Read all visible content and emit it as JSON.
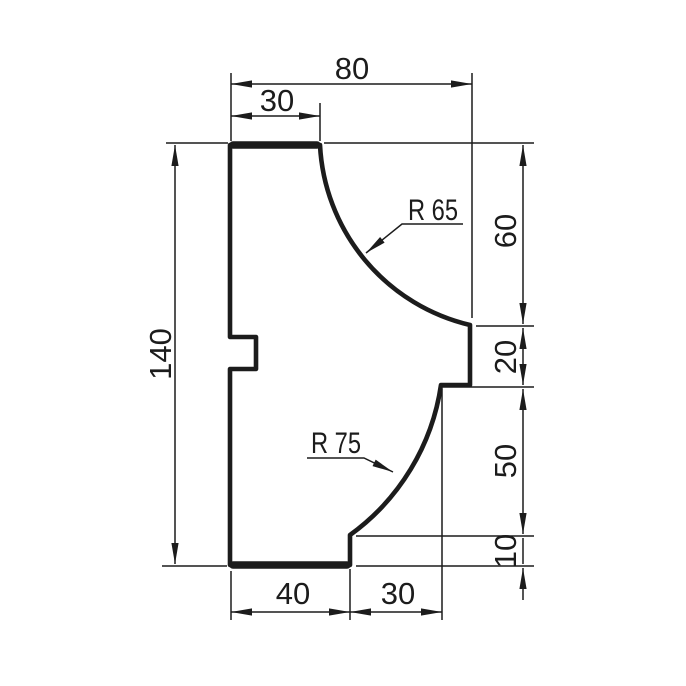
{
  "drawing": {
    "ink_color": "#1c1c1c",
    "background_color": "#ffffff",
    "labels": {
      "dim_top_width": "80",
      "dim_top_shelf_width": "30",
      "dim_overall_height": "140",
      "dim_right_upper_height": "60",
      "dim_right_middle_height": "20",
      "dim_right_lower_height": "50",
      "dim_right_bottom_height": "10",
      "dim_bottom_left_width": "40",
      "dim_bottom_right_width": "30",
      "radius_upper": "R 65",
      "radius_lower": "R 75"
    }
  }
}
